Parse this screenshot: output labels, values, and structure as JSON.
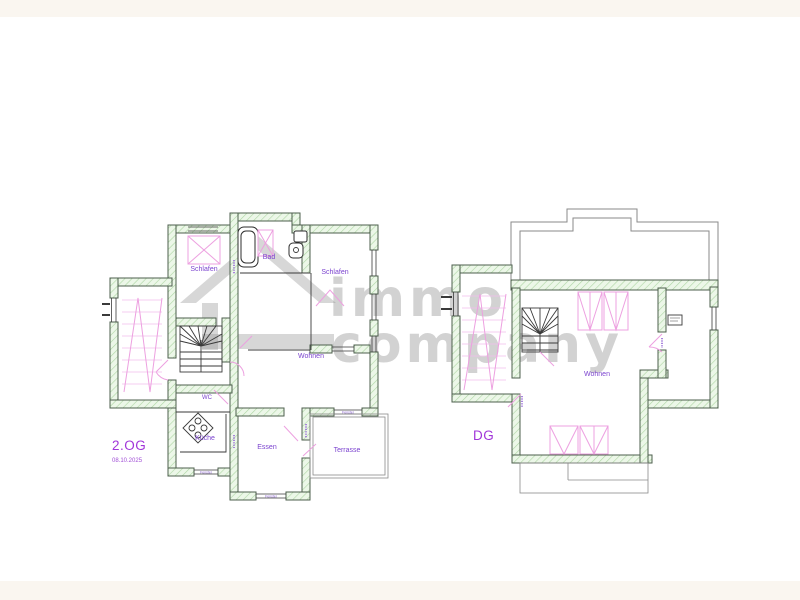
{
  "frame": {
    "background": "#faf6f0",
    "canvas": "#ffffff"
  },
  "watermark": {
    "line1": "immo",
    "line2": "company",
    "color": "#909090",
    "icon": "house-gable-icon"
  },
  "plans": {
    "og2": {
      "floor_label": "2.OG",
      "date": "08.10.2025",
      "rooms": {
        "schlafen_left": "Schlafen",
        "bad": "Bad",
        "schlafen_right": "Schlafen",
        "wohnen": "Wohnen",
        "wc": "WC",
        "kueche": "Küche",
        "essen": "Essen",
        "terrasse": "Terrasse"
      },
      "window_labels": {
        "kueche_bottom": "Fenster",
        "essen_bottom": "Fenster",
        "terrasse_top": "Fenster"
      }
    },
    "dg": {
      "floor_label": "DG",
      "rooms": {
        "wohnen": "Wohnen"
      }
    }
  },
  "colors": {
    "wall_fill": "#ecf7e8",
    "wall_hatch": "#aed6a4",
    "wall_stroke": "#4d5f4d",
    "interior_line": "#3a3a3a",
    "roof_outline": "#8a8a8a",
    "furniture_pink": "#eda0e0",
    "room_label": "#7b43cf",
    "floor_label": "#a136d9",
    "date_label": "#a14fd6"
  }
}
